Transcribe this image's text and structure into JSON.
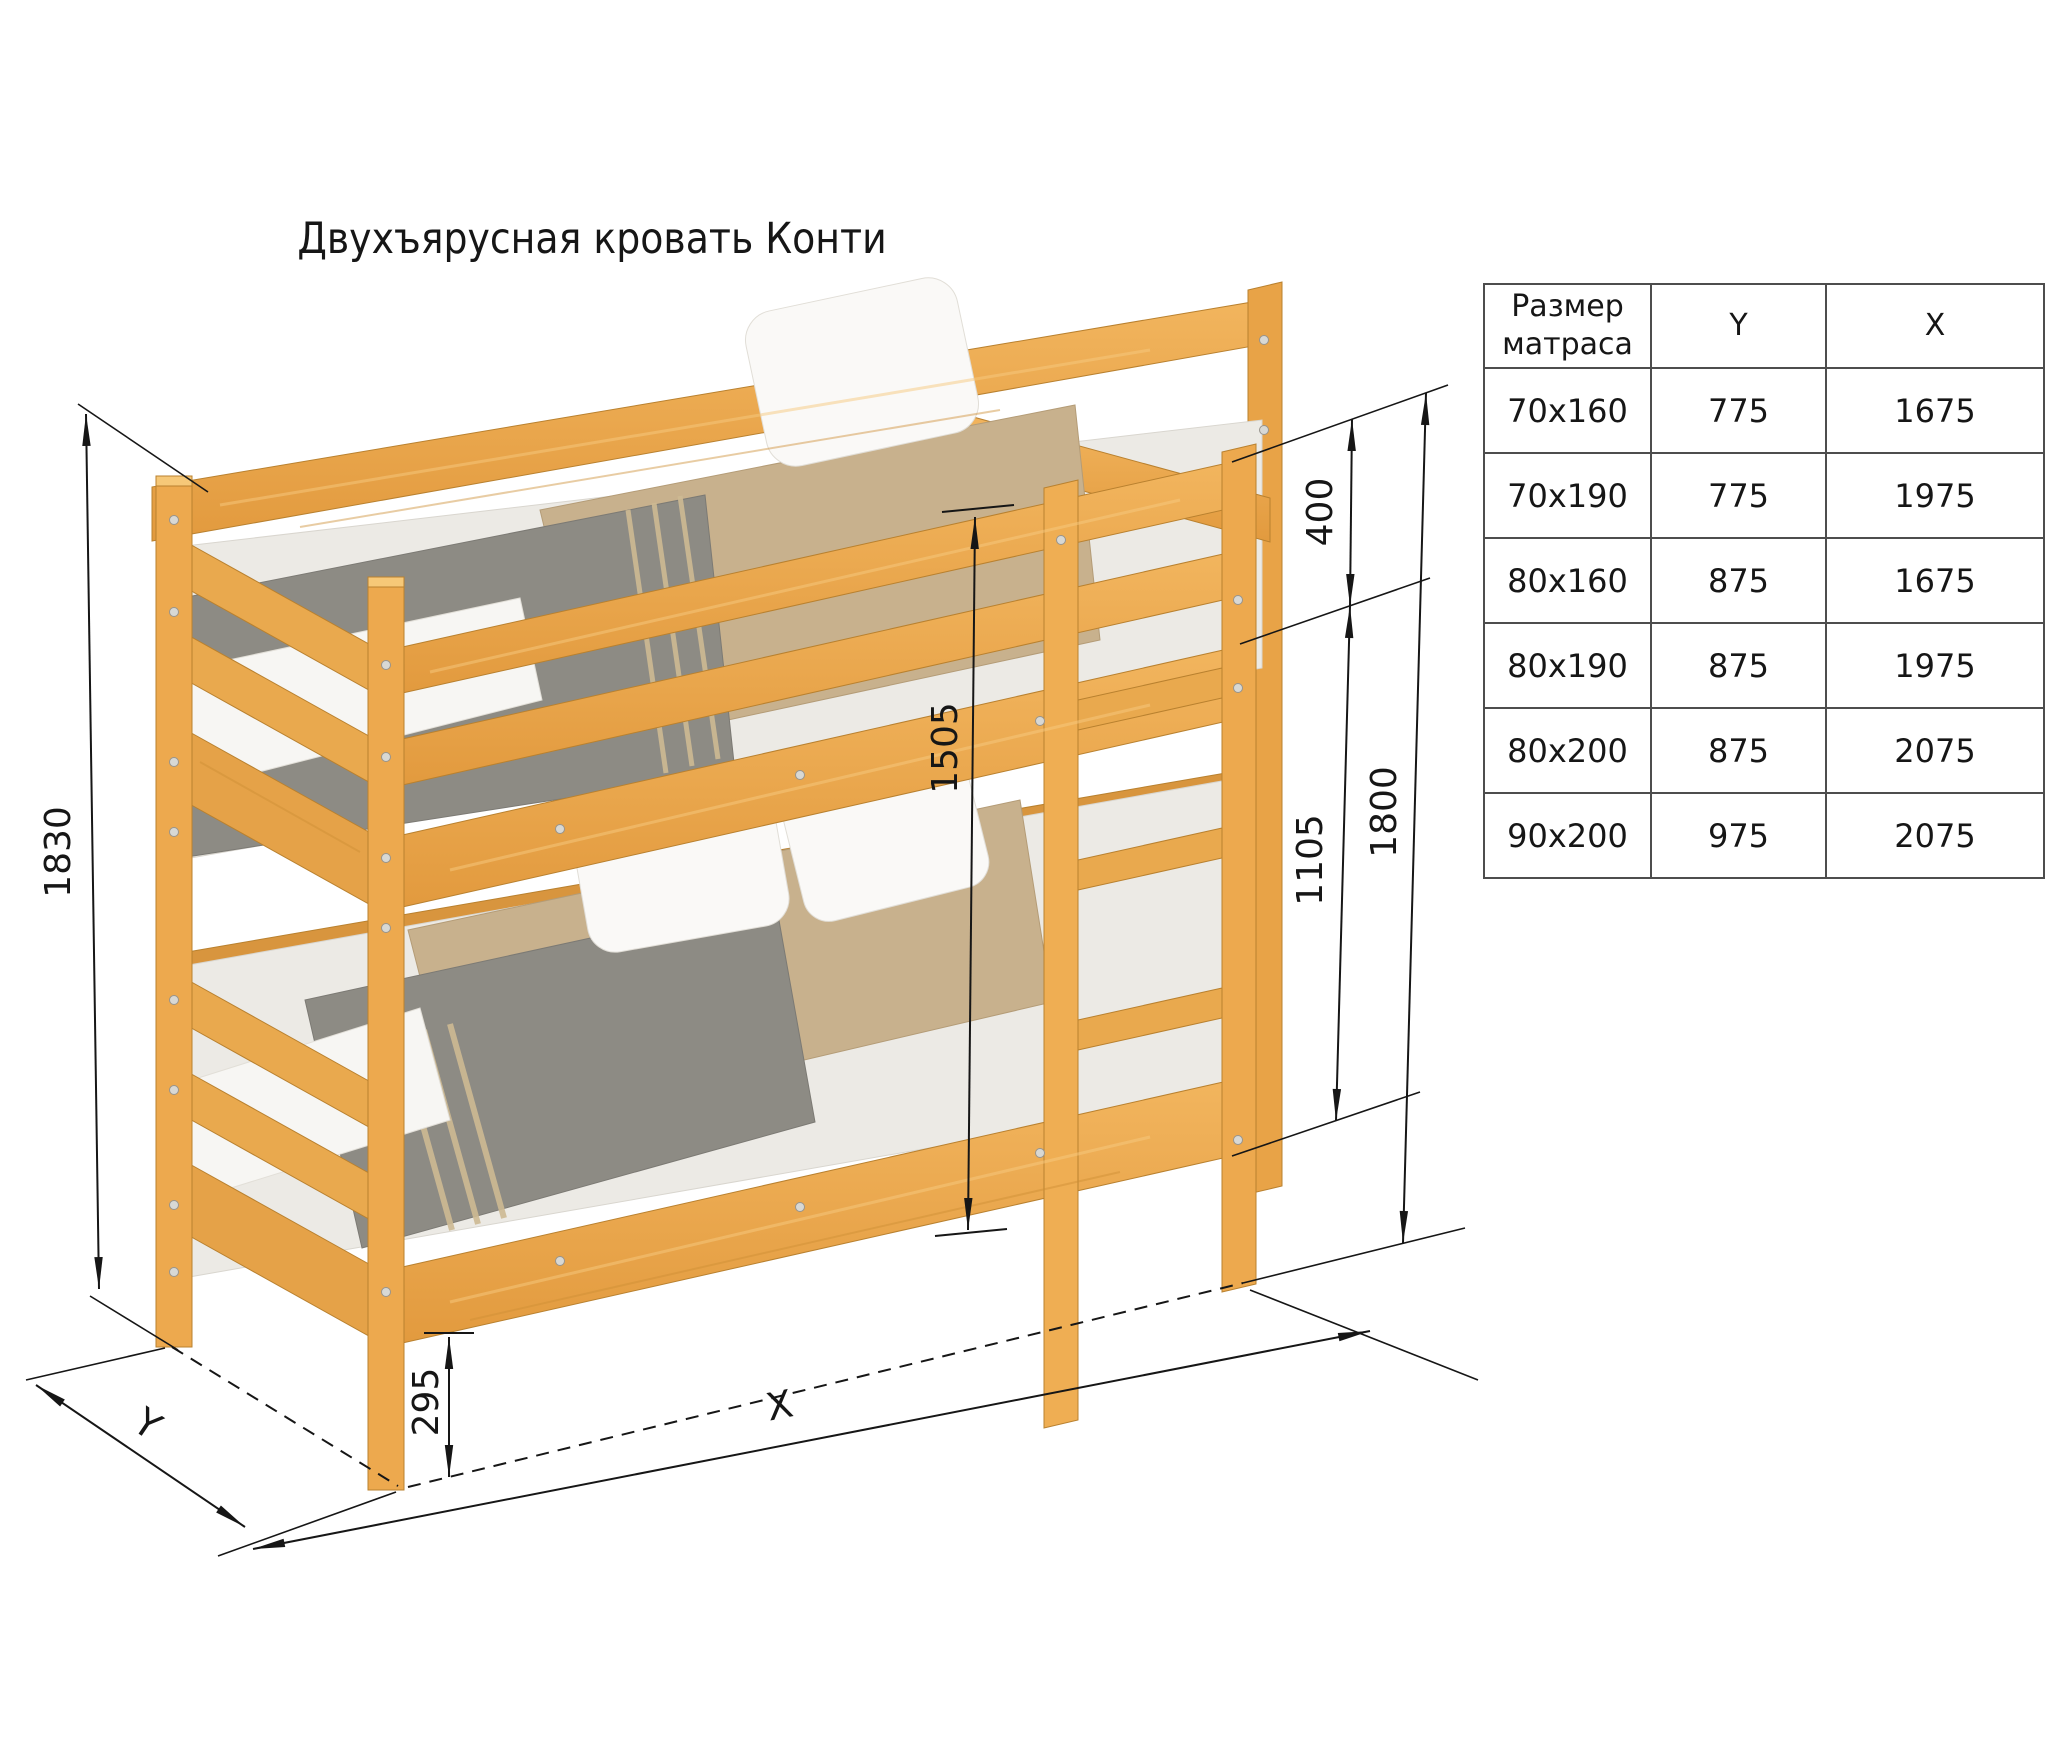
{
  "title": "Двухъярусная кровать Конти",
  "table": {
    "col_headers": [
      "Размер матраса",
      "Y",
      "X"
    ],
    "rows": [
      {
        "size": "70x160",
        "y": "775",
        "x": "1675"
      },
      {
        "size": "70x190",
        "y": "775",
        "x": "1975"
      },
      {
        "size": "80x160",
        "y": "875",
        "x": "1675"
      },
      {
        "size": "80x190",
        "y": "875",
        "x": "1975"
      },
      {
        "size": "80x200",
        "y": "875",
        "x": "2075"
      },
      {
        "size": "90x200",
        "y": "975",
        "x": "2075"
      }
    ]
  },
  "dimensions": {
    "overall_height": "1830",
    "guard_to_floor": "1800",
    "guard_above_mattress": "400",
    "under_frame_height": "1105",
    "inner_height": "1505",
    "under_bed_clearance": "295",
    "length_label": "X",
    "depth_label": "Y"
  },
  "colors": {
    "wood": "#EDA94E",
    "wood_dark": "#DE9A3F",
    "wood_light": "#F3BC67",
    "mattress": "#ECEAE5",
    "blanket_gray": "#8D8B84",
    "blanket_tan": "#C8B18D",
    "pillow": "#FAF9F7",
    "line": "#161616",
    "background": "#FFFFFF"
  }
}
